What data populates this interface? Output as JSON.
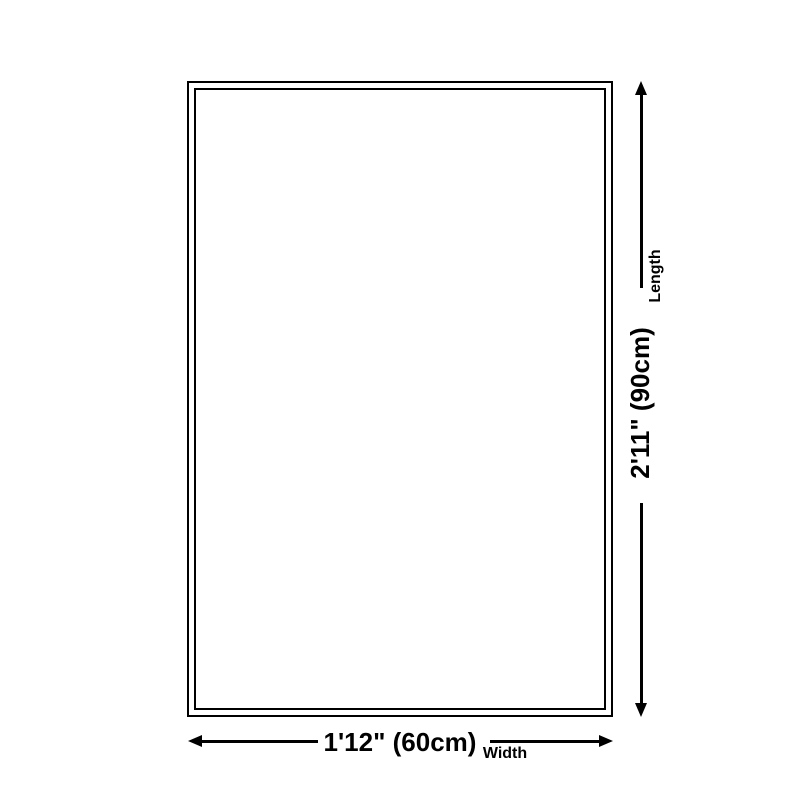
{
  "page": {
    "background_color": "#ffffff",
    "line_color": "#000000"
  },
  "diagram": {
    "item": "rug size outline",
    "length_dimension": {
      "value": "2'11\" (90cm)",
      "axis_label": "Length"
    },
    "width_dimension": {
      "value": "1'12\" (60cm)",
      "axis_label": "Width"
    }
  }
}
